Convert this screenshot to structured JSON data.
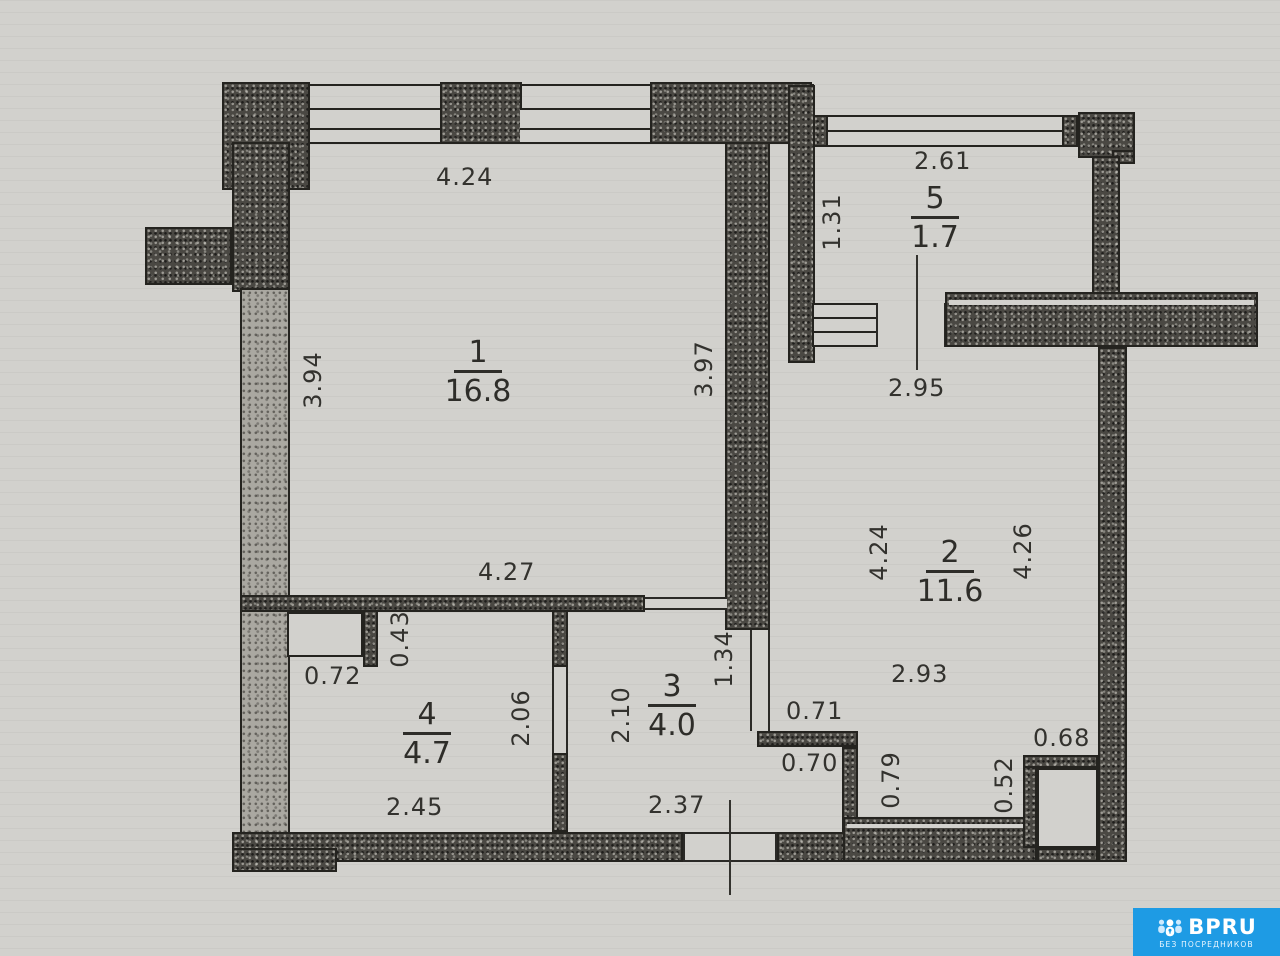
{
  "document": {
    "type": "apartment floor plan (scan)"
  },
  "rooms": [
    {
      "number": "1",
      "area": "16.8"
    },
    {
      "number": "2",
      "area": "11.6"
    },
    {
      "number": "3",
      "area": "4.0"
    },
    {
      "number": "4",
      "area": "4.7"
    },
    {
      "number": "5",
      "area": "1.7"
    }
  ],
  "dims": {
    "room1_top": "4.24",
    "room1_left": "3.94",
    "room1_right": "3.97",
    "room1_bottom": "4.27",
    "balcony_top": "2.61",
    "balcony_left": "1.31",
    "balcony_wall": "2.95",
    "room2_left": "4.24",
    "room2_right": "4.26",
    "room2_bottom": "2.93",
    "niche_width": "0.72",
    "niche_height": "0.43",
    "room4_right": "2.06",
    "room4_bottom": "2.45",
    "room3_left": "2.10",
    "room3_right": "1.34",
    "room3_bottom": "2.37",
    "step_top": "0.71",
    "step_bottom": "0.70",
    "notch_left": "0.79",
    "shaft_left": "0.52",
    "shaft_top": "0.68"
  },
  "logo": {
    "brand": "BPRU",
    "tagline": "БЕЗ ПОСРЕДНИКОВ",
    "bg_color": "#1e9be4"
  },
  "colors": {
    "paper": "#d2d1cd",
    "ink": "#24231f",
    "wall_fill": "#4a4843"
  }
}
